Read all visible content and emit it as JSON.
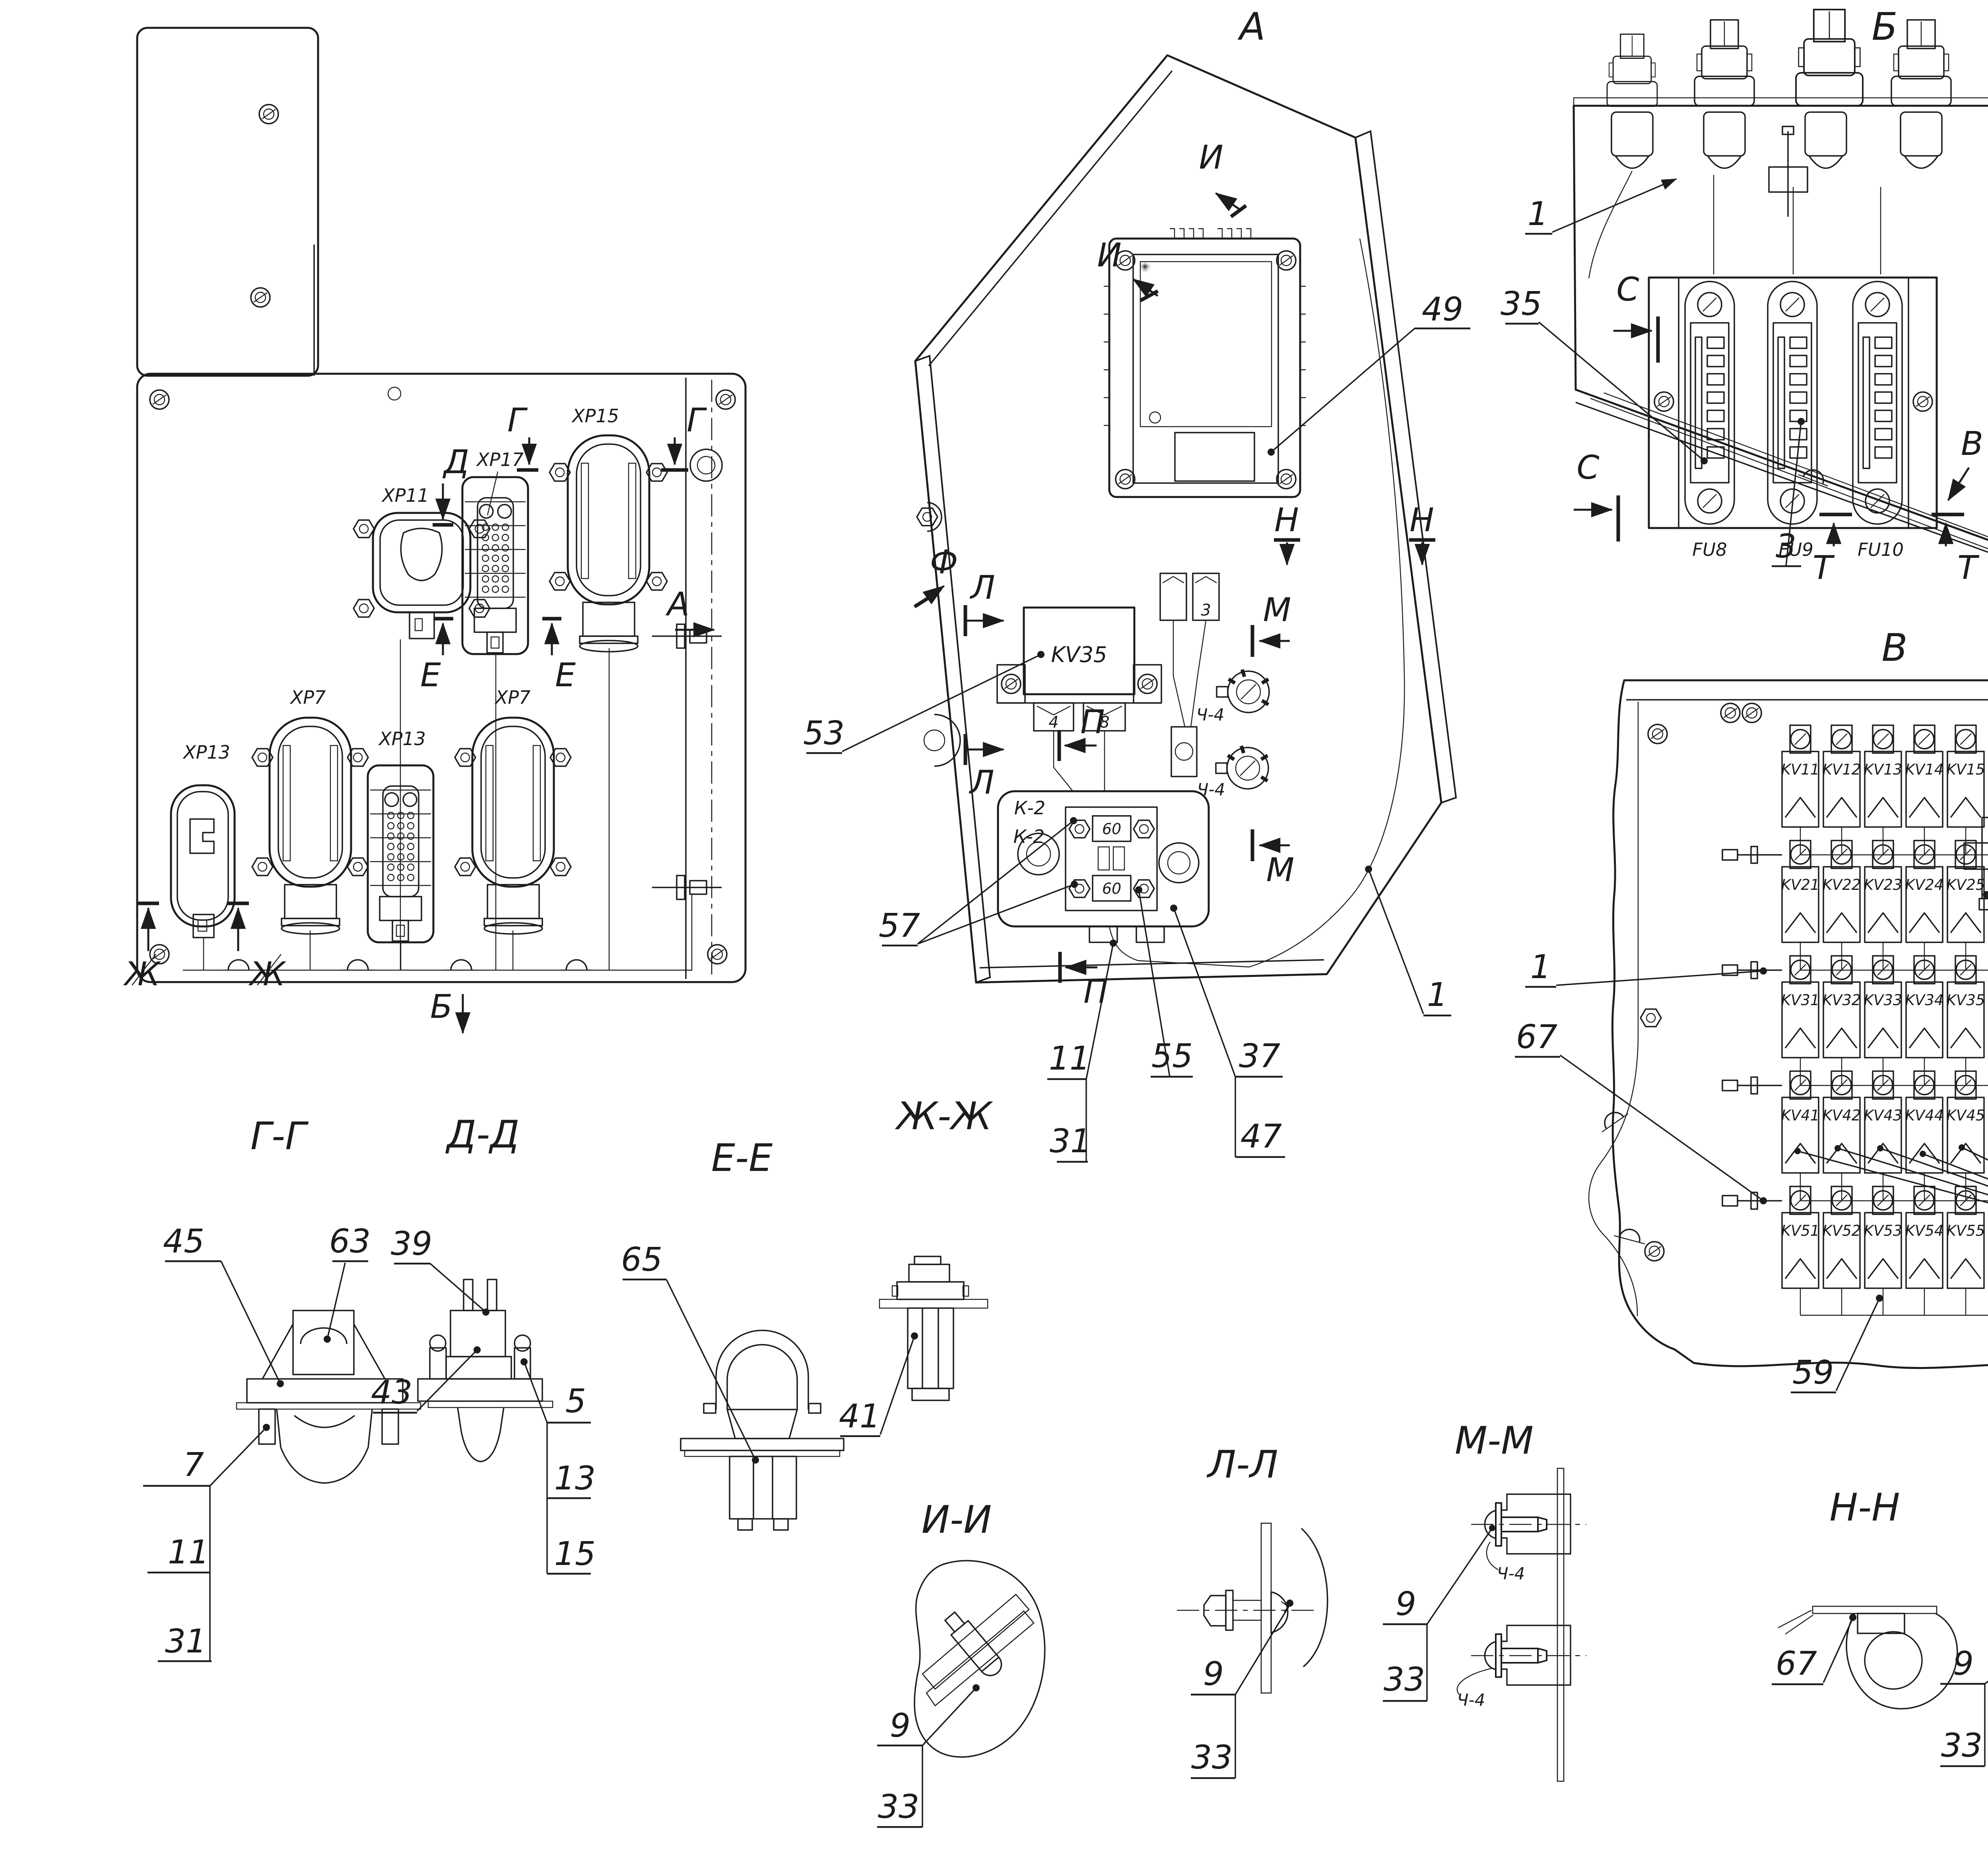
{
  "colors": {
    "ink": "#1c1c1c",
    "bg": "#ffffff"
  },
  "main": {
    "xp11": "ХР11",
    "xp17": "ХР17",
    "xp15": "ХР15",
    "xp13a": "ХР13",
    "xp7a": "ХР7",
    "xp13b": "ХР13",
    "xp7b": "ХР7",
    "mark_g": "Г",
    "mark_d": "Д",
    "mark_e": "Е",
    "mark_zh": "Ж",
    "mark_a": "А",
    "mark_b": "Б"
  },
  "va": {
    "title": "А",
    "mark_i": "И",
    "mark_f": "Ф",
    "mark_l": "Л",
    "mark_p": "П",
    "mark_n": "Н",
    "mark_m": "М",
    "kv35": "KV35",
    "pin4": "4",
    "pin8": "8",
    "aux3": "3",
    "k2": "К-2",
    "f60": "60",
    "ch4": "Ч-4",
    "c49": "49",
    "c53": "53",
    "c57": "57",
    "c11": "11",
    "c31": "31",
    "c55": "55",
    "c37": "37",
    "c47": "47",
    "c1": "1"
  },
  "vb": {
    "title": "Б",
    "mark_s": "С",
    "mark_t": "Т",
    "mark_v": "В",
    "fu8": "FU8",
    "fu9": "FU9",
    "fu10": "FU10",
    "c1": "1",
    "c35": "35",
    "c3": "3"
  },
  "vv": {
    "title": "В",
    "mark_r": "Р",
    "rows": [
      [
        "KV11",
        "KV12",
        "KV13",
        "KV14",
        "KV15",
        "KV16"
      ],
      [
        "KV21",
        "KV22",
        "KV23",
        "KV24",
        "KV25",
        "KV26"
      ],
      [
        "KV31",
        "KV32",
        "KV33",
        "KV34",
        "KV35",
        "KV36",
        "KV37",
        "KV38"
      ],
      [
        "KV41",
        "KV42",
        "KV43",
        "KV44",
        "KV45",
        "KV46"
      ],
      [
        "KV51",
        "KV52",
        "KV53",
        "KV54",
        "KV55",
        "KV56"
      ]
    ],
    "c34": "34",
    "c67": "67",
    "c1": "1",
    "c59": "59",
    "c60": "60"
  },
  "det": {
    "ff": {
      "t": "Ф-Ф",
      "a": "9",
      "b": "33"
    },
    "tt": {
      "t": "Т-Т",
      "a": "7",
      "b": "23",
      "c": "31",
      "u": "У"
    },
    "ss": {
      "t": "С-С",
      "a": "9",
      "b": "33"
    },
    "rr": {
      "t": "Р-Р(1:1)",
      "s": "32 разреза",
      "a": "7 или 19",
      "b": "31"
    },
    "gg": {
      "t": "Г-Г",
      "a": "45",
      "b": "63",
      "c": "7",
      "d": "11",
      "e": "31"
    },
    "dd": {
      "t": "Д-Д",
      "a": "39",
      "b": "43",
      "c": "5",
      "d": "13",
      "e": "15"
    },
    "ee": {
      "t": "Е-Е",
      "a": "65"
    },
    "zh": {
      "t": "Ж-Ж",
      "a": "41"
    },
    "ii": {
      "t": "И-И",
      "a": "9",
      "b": "33"
    },
    "ll": {
      "t": "Л-Л",
      "a": "9",
      "b": "33"
    },
    "mm": {
      "t": "М-М",
      "a": "9",
      "b": "33",
      "ch": "Ч-4"
    },
    "nn": {
      "t": "Н-Н",
      "a": "67"
    },
    "pp": {
      "t": "П-П",
      "a": "9",
      "b": "33"
    }
  }
}
